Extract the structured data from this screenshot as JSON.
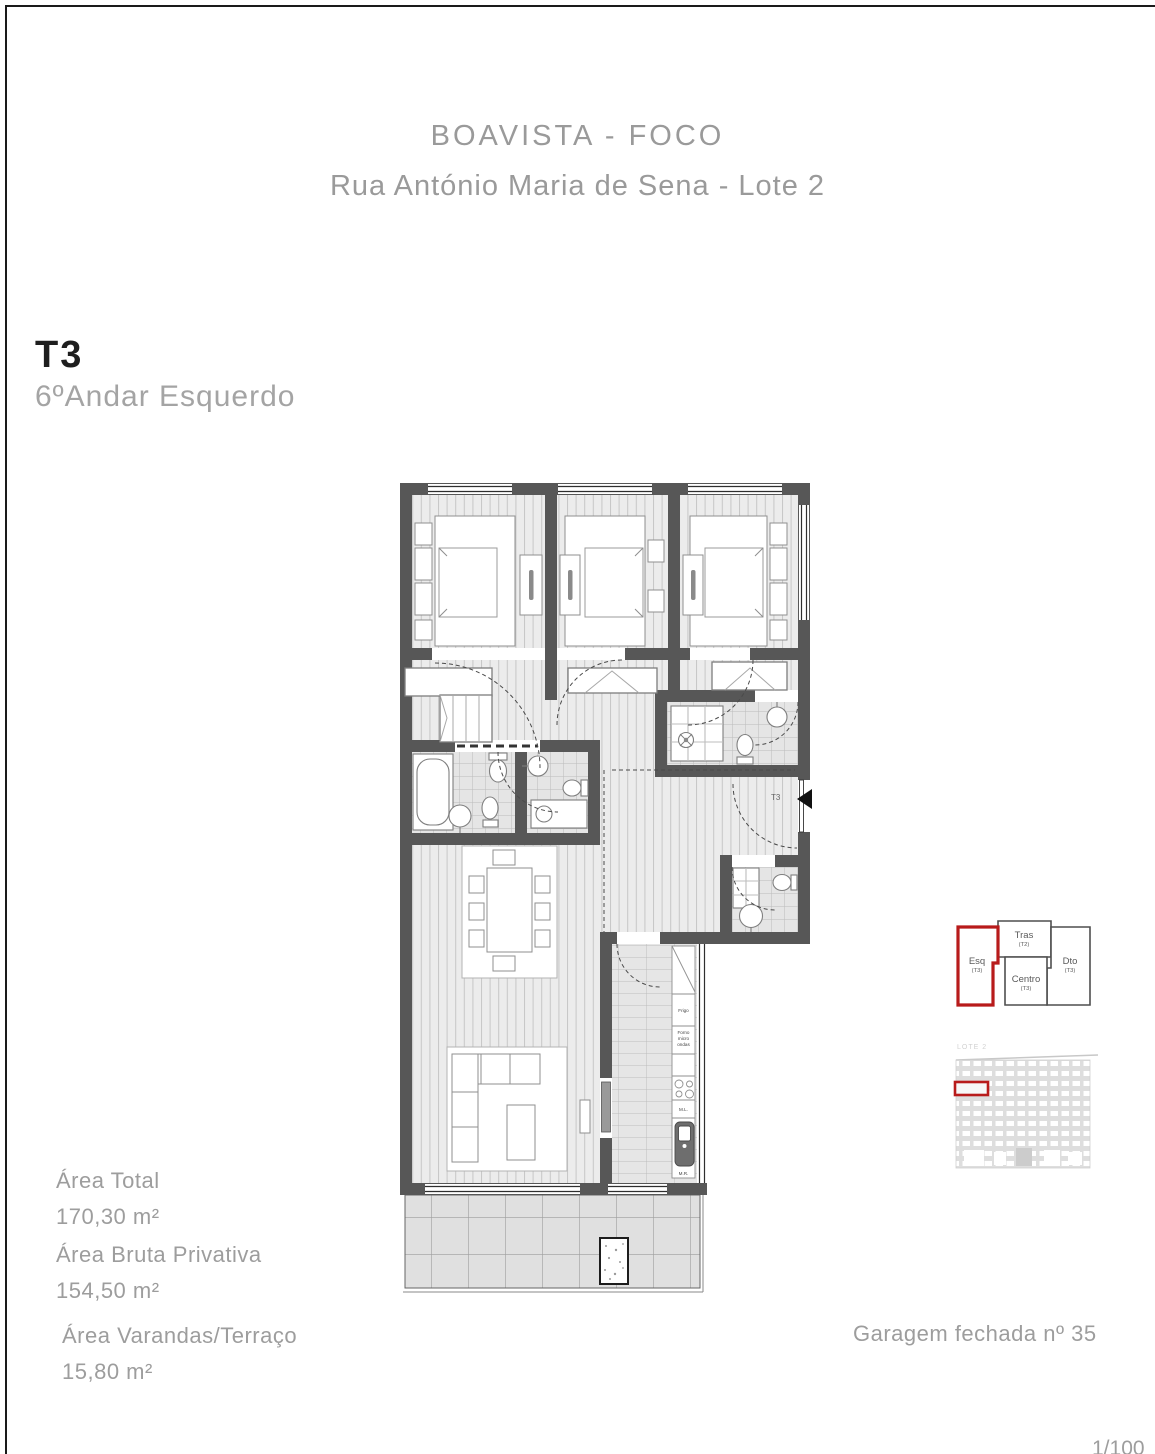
{
  "page": {
    "scale_label": "1/100"
  },
  "header": {
    "title": "BOAVISTA - FOCO",
    "subtitle": "Rua António Maria de Sena - Lote 2"
  },
  "unit": {
    "type": "T3",
    "floor": "6ºAndar Esquerdo"
  },
  "areas": {
    "total": {
      "label": "Área Total",
      "value": "170,30 m²"
    },
    "gross_private": {
      "label": "Área Bruta Privativa",
      "value": "154,50 m²"
    },
    "balconies": {
      "label": "Área Varandas/Terraço",
      "value": "15,80 m²"
    }
  },
  "garage": {
    "label": "Garagem fechada nº 35"
  },
  "floorplan": {
    "entrance_label": "T3",
    "kitchen": {
      "fridge": "Frigo",
      "oven_lines": [
        "Forno",
        "micro",
        "ondas"
      ],
      "washer": "M.L.",
      "mr": "M.R."
    }
  },
  "locator": {
    "lot_label": "LOTE 2",
    "units": [
      {
        "name": "Esq",
        "type": "(T3)",
        "highlighted": true
      },
      {
        "name": "Tras",
        "type": "(T2)",
        "highlighted": false
      },
      {
        "name": "Dto",
        "type": "(T3)",
        "highlighted": false
      },
      {
        "name": "Centro",
        "type": "(T3)",
        "highlighted": false
      }
    ]
  },
  "colors": {
    "accent_red": "#b81b1b",
    "wall_gray": "#575757",
    "text_gray": "#9c9c9c"
  }
}
